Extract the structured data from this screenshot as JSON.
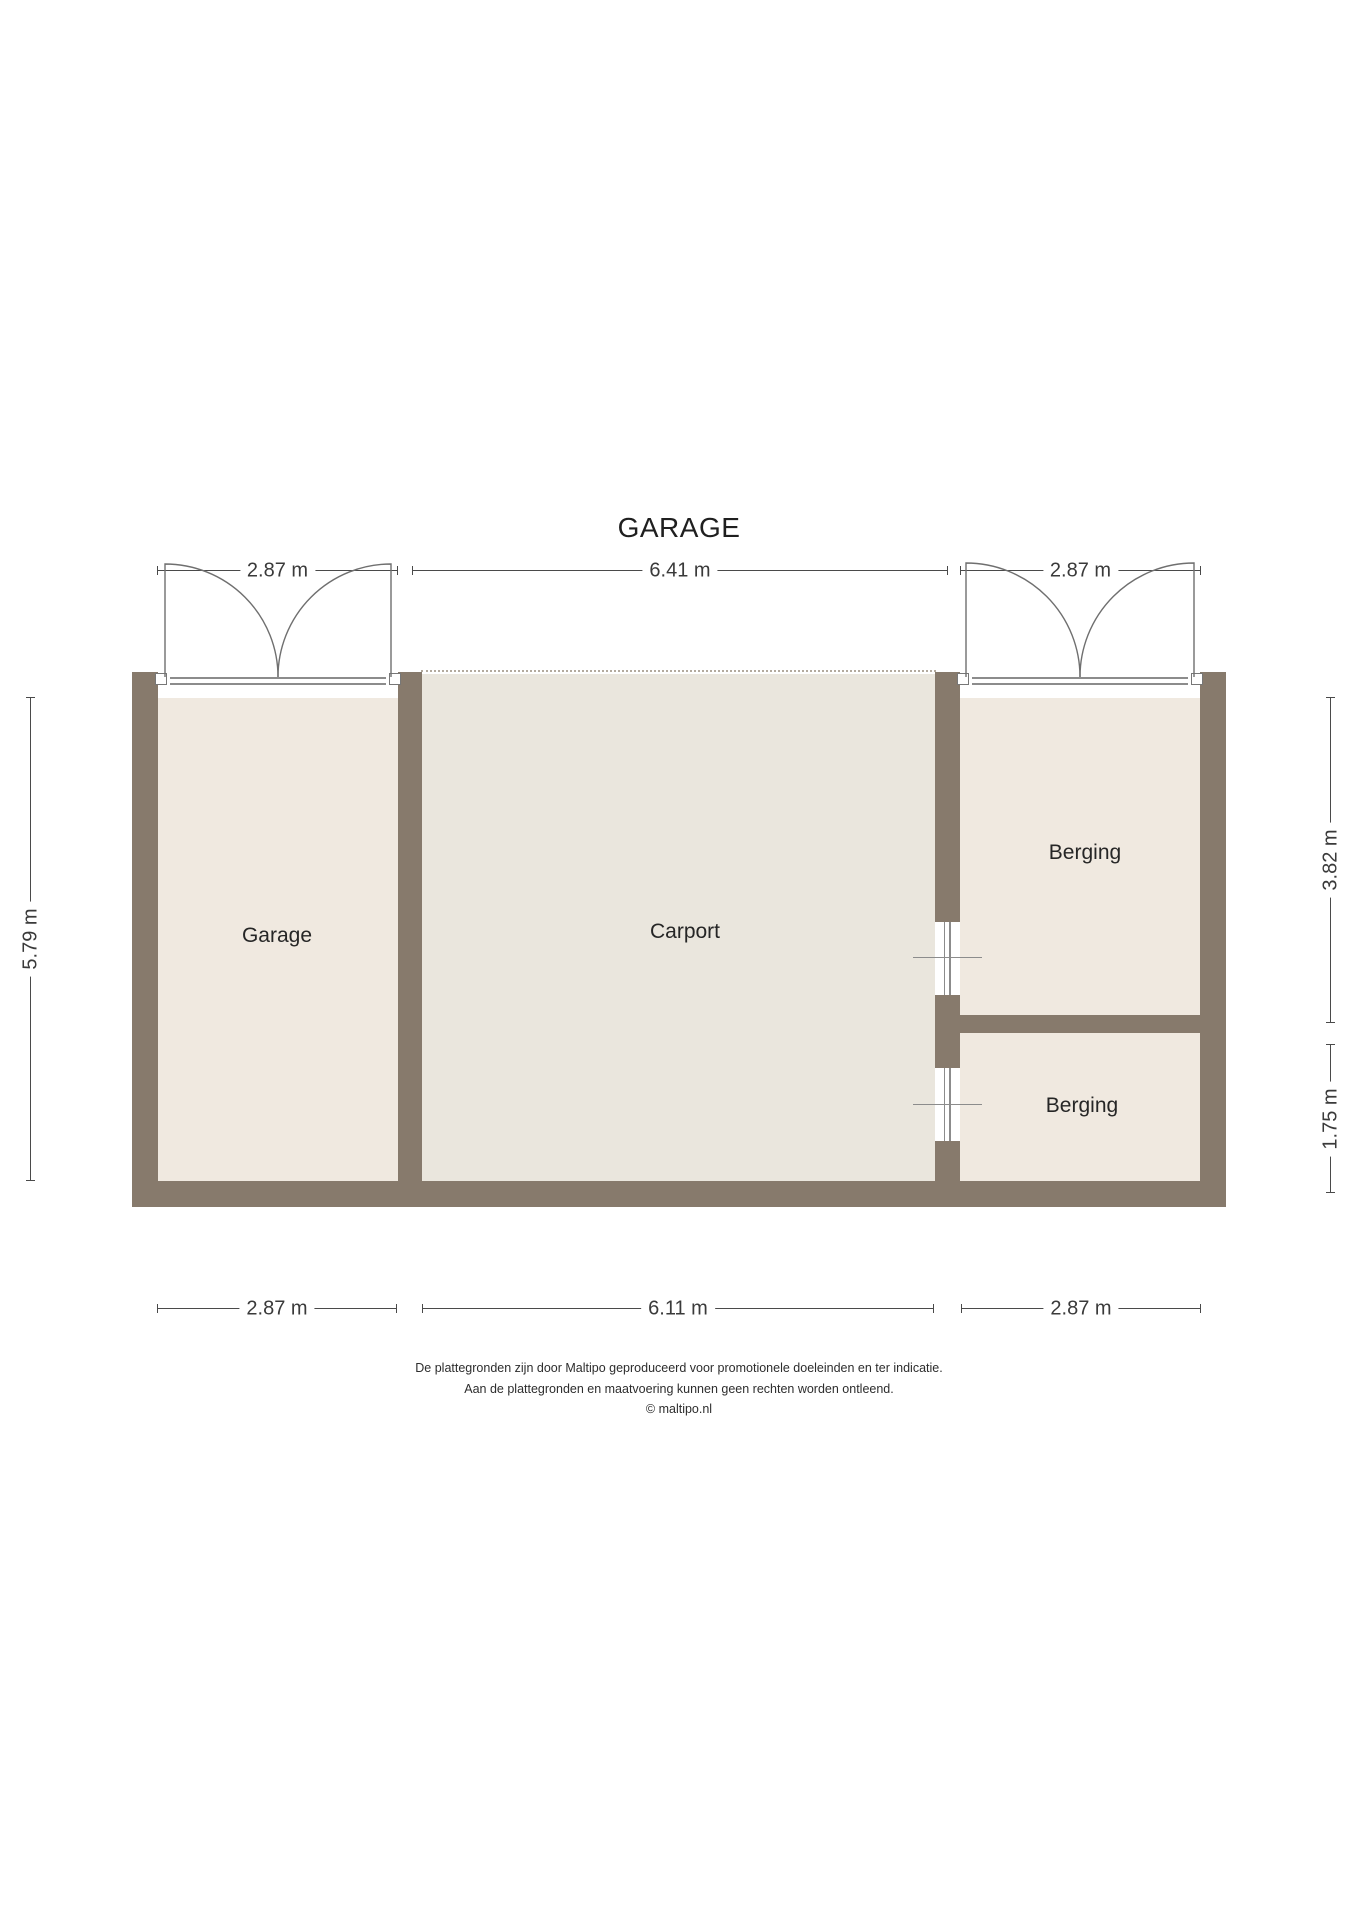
{
  "title": "GARAGE",
  "rooms": [
    {
      "name": "Garage"
    },
    {
      "name": "Carport"
    },
    {
      "name": "Berging"
    },
    {
      "name": "Berging"
    }
  ],
  "dimensions": {
    "top": [
      "2.87 m",
      "6.41 m",
      "2.87 m"
    ],
    "bottom": [
      "2.87 m",
      "6.11 m",
      "2.87 m"
    ],
    "left": [
      "5.79 m"
    ],
    "right": [
      "3.82 m",
      "1.75 m"
    ]
  },
  "footer": [
    "De plattegronden zijn door Maltipo geproduceerd voor promotionele doeleinden en ter indicatie.",
    "Aan de plattegronden en maatvoering kunnen geen rechten worden ontleend.",
    "© maltipo.nl"
  ],
  "colors": {
    "wall": "#877a6c",
    "floor": "#f0e9e0",
    "carport_floor": "#eae6dd",
    "line": "#6f6f6f"
  }
}
